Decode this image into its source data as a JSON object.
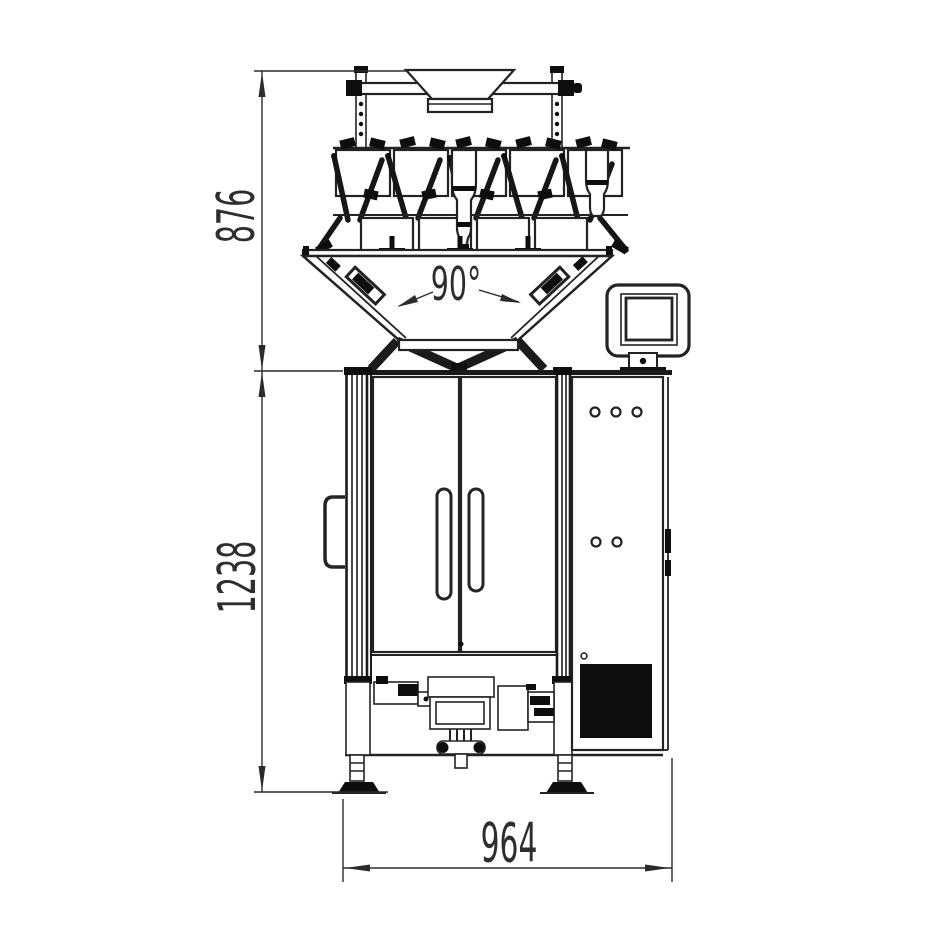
{
  "drawing": {
    "subject": "vertical-packaging-machine-with-multihead-weigher",
    "view": "front-elevation",
    "background": "#ffffff",
    "line_color": "#232323",
    "fill_color": "#0e0e0e"
  },
  "annotations": {
    "dim_weigher_height": {
      "label": "876",
      "orientation": "vertical"
    },
    "dim_body_height": {
      "label": "1238",
      "orientation": "vertical"
    },
    "dim_width": {
      "label": "964",
      "orientation": "horizontal"
    },
    "cone_angle": {
      "label": "90°"
    }
  }
}
